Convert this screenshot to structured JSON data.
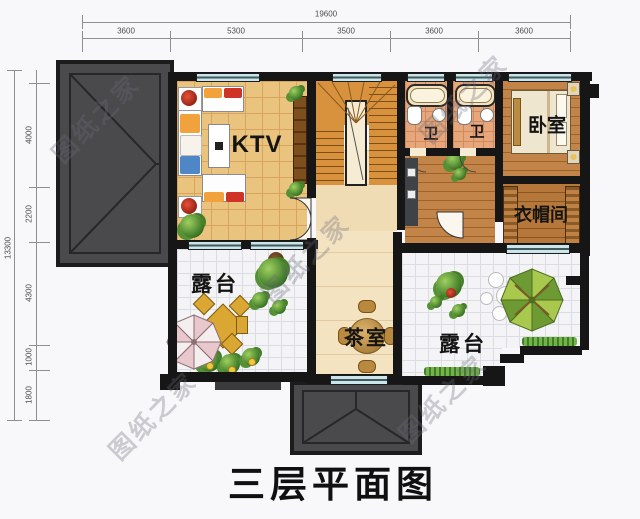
{
  "title": "三层平面图",
  "watermark": {
    "text": "图纸之家"
  },
  "dims": {
    "top_total": "19600",
    "top": [
      "3600",
      "5300",
      "3500",
      "3600",
      "3600"
    ],
    "left_total": "13300",
    "left": [
      "4000",
      "2200",
      "4300",
      "1000",
      "1800"
    ]
  },
  "rooms": {
    "ktv": "KTV",
    "bedroom": "卧室",
    "closet": "衣帽间",
    "bath_left": "卫",
    "bath_right": "卫",
    "terrace_left": "露台",
    "terrace_right": "露台",
    "tea": "茶室"
  },
  "colors": {
    "wall": "#161616",
    "roof": "#4a4a4c",
    "ktv_floor": "#eac47f",
    "wood_floor": "#c28448",
    "terrace_floor": "#f4f4f6",
    "window": "#cbe6ea"
  }
}
